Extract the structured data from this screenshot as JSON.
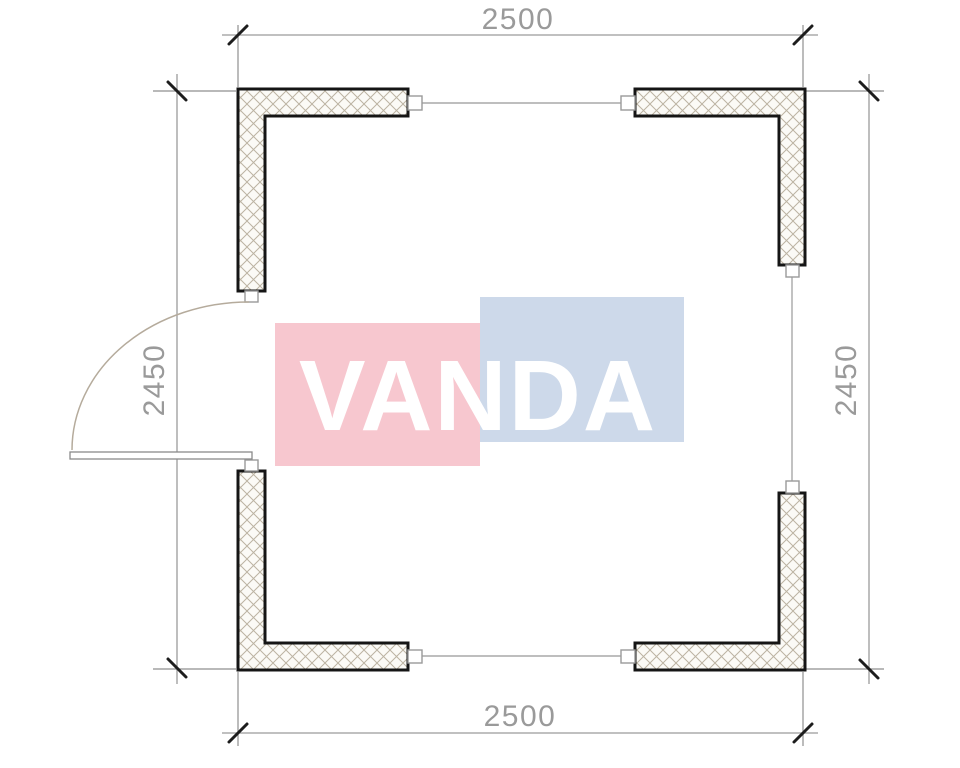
{
  "drawing": {
    "type": "floor-plan",
    "description": "Square cabin floor plan with four L-shaped hatched corner walls, wall links, and a left-hand entrance door swing"
  },
  "dimensions": {
    "top": "2500",
    "bottom": "2500",
    "left": "2450",
    "right": "2450"
  },
  "watermark": {
    "text": "VANDA",
    "pink_color": "#f7c7cf",
    "blue_color": "#cdd9ea",
    "text_color": "#ffffff"
  },
  "colors": {
    "background": "#ffffff",
    "wall_outline": "#151515",
    "hatch_line": "#bcb3a2",
    "hatch_fill": "#fbfaf6",
    "dimension_line": "#9b9b9b",
    "dimension_text": "#9a9a9a",
    "tick": "#1d1d1d",
    "door_arc": "#b5ab9c"
  }
}
